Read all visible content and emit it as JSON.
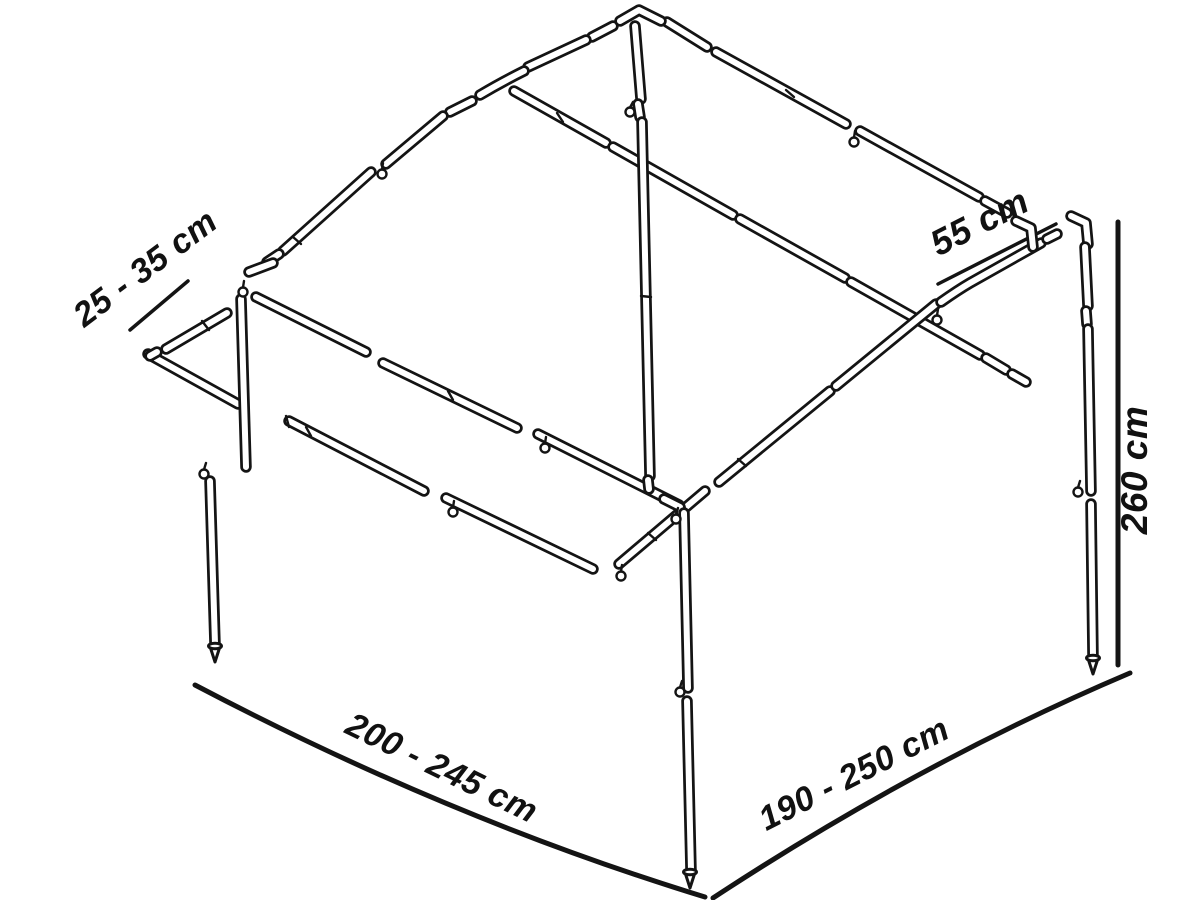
{
  "figure": {
    "description": "Exploded isometric line drawing of a telescopic awning / tent pole frame with dimension annotations"
  },
  "dimensions": {
    "extension": {
      "label": "25 - 35 cm"
    },
    "corner_brace": {
      "label": "55 cm"
    },
    "height": {
      "label": "260 cm"
    },
    "front_width": {
      "label": "200 - 245 cm"
    },
    "side_depth": {
      "label": "190 - 250 cm"
    }
  },
  "colors": {
    "line": "#141414",
    "background": "#ffffff"
  }
}
